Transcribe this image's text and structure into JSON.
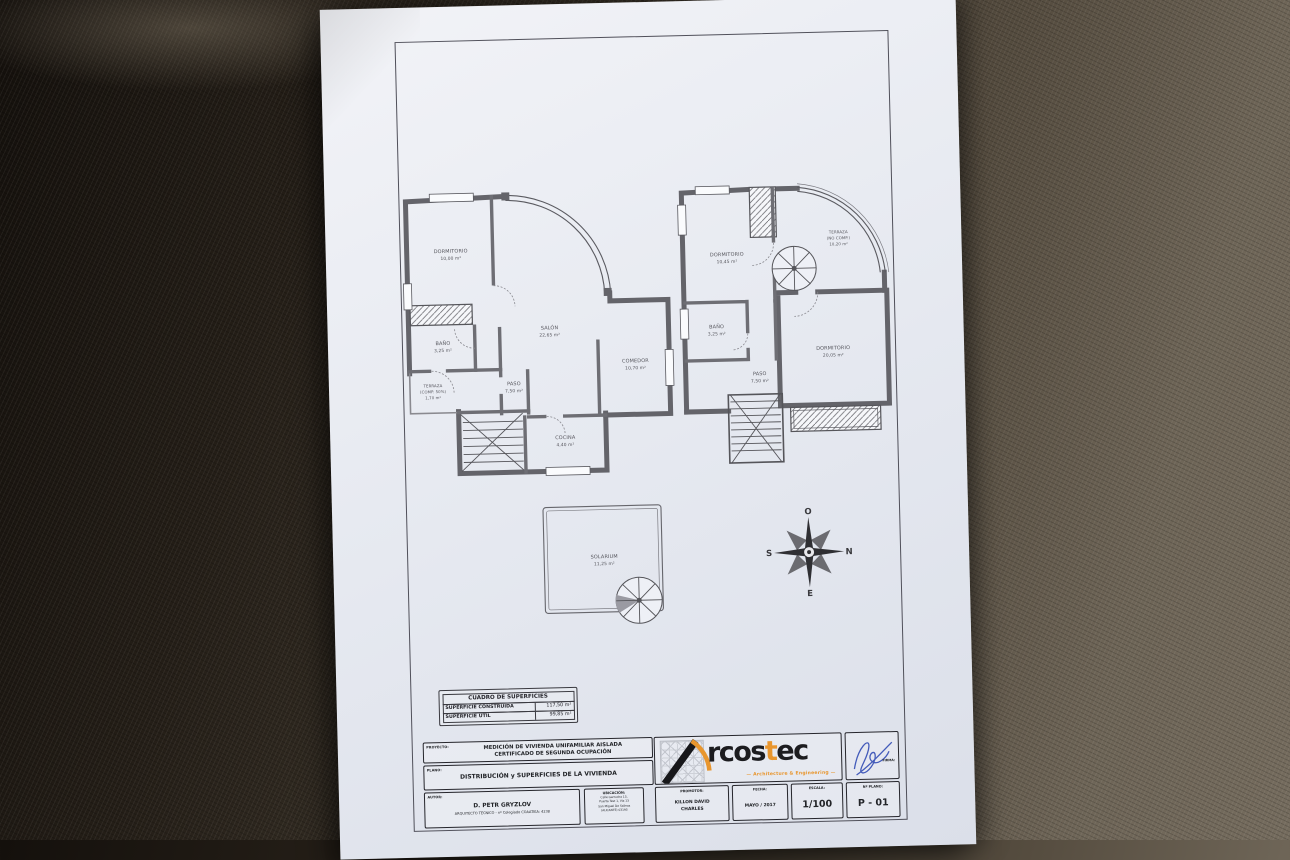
{
  "plans": {
    "ground_floor": {
      "rooms": [
        {
          "name": "DORMITORIO",
          "area": "10,00 m²"
        },
        {
          "name": "SALÓN",
          "area": "22,65 m²"
        },
        {
          "name": "COMEDOR",
          "area": "10,70 m²"
        },
        {
          "name": "BAÑO",
          "area": "3,25 m²"
        },
        {
          "name": "TERRAZA",
          "note": "(COMP. 50%)",
          "area": "1,70 m²"
        },
        {
          "name": "PASO",
          "area": "7,50 m²"
        },
        {
          "name": "COCINA",
          "area": "4,40 m²"
        }
      ]
    },
    "first_floor": {
      "rooms": [
        {
          "name": "DORMITORIO",
          "area": "10,45 m²"
        },
        {
          "name": "TERRAZA",
          "note": "(NO COMP.)",
          "area": "10,20 m²"
        },
        {
          "name": "BAÑO",
          "area": "3,25 m²"
        },
        {
          "name": "PASO",
          "area": "7,50 m²"
        },
        {
          "name": "DORMITORIO",
          "area": "20,05 m²"
        }
      ]
    },
    "solarium": {
      "name": "SOLARIUM",
      "area": "11,25 m²"
    }
  },
  "compass": {
    "top": "O",
    "right": "N",
    "bottom": "E",
    "left": "S"
  },
  "surfaces_table": {
    "title": "CUADRO DE SUPERFICIES",
    "rows": [
      {
        "label": "SUPERFICIE CONSTRUIDA",
        "value": "117,50 m²"
      },
      {
        "label": "SUPERFICIE ÚTIL",
        "value": "99,85 m²"
      }
    ]
  },
  "title_block": {
    "proyecto_label": "PROYECTO:",
    "proyecto_line1": "MEDICIÓN DE VIVIENDA UNIFAMILIAR AISLADA",
    "proyecto_line2": "CERTIFICADO DE SEGUNDA OCUPACIÓN",
    "plano_label": "PLANO:",
    "plano_value": "DISTRIBUCIÓN y SUPERFICIES DE LA VIVIENDA",
    "autor_label": "AUTOR:",
    "autor_name": "D. PETR GRYZLOV",
    "autor_title": "ARQUITECTO TÉCNICO - nº Colegiado COAATIEA: 4238",
    "ubicacion_label": "UBICACIÓN:",
    "ubicacion_line1": "Calle Garrucha 13,",
    "ubicacion_line2": "Puerta Test 1, Via 13",
    "ubicacion_line3": "San Miguel De Salinas",
    "ubicacion_line4": "(ALICANTE) 03193",
    "promotor_label": "PROMOTOR:",
    "promotor_line1": "KILLON DAVID",
    "promotor_line2": "CHARLES",
    "fecha_label": "FECHA:",
    "fecha_value": "MAYO / 2017",
    "escala_label": "ESCALA:",
    "escala_value": "1/100",
    "nplano_label": "Nº PLANO:",
    "nplano_value": "P - 01",
    "firma_label": "FIRMA:",
    "brand": "Arcostec",
    "logo_text1": "rcos",
    "logo_accent": "t",
    "logo_text2": "ec",
    "logo_tagline": "— Architecture & Engineering —",
    "accent_color": "#e8962e"
  }
}
